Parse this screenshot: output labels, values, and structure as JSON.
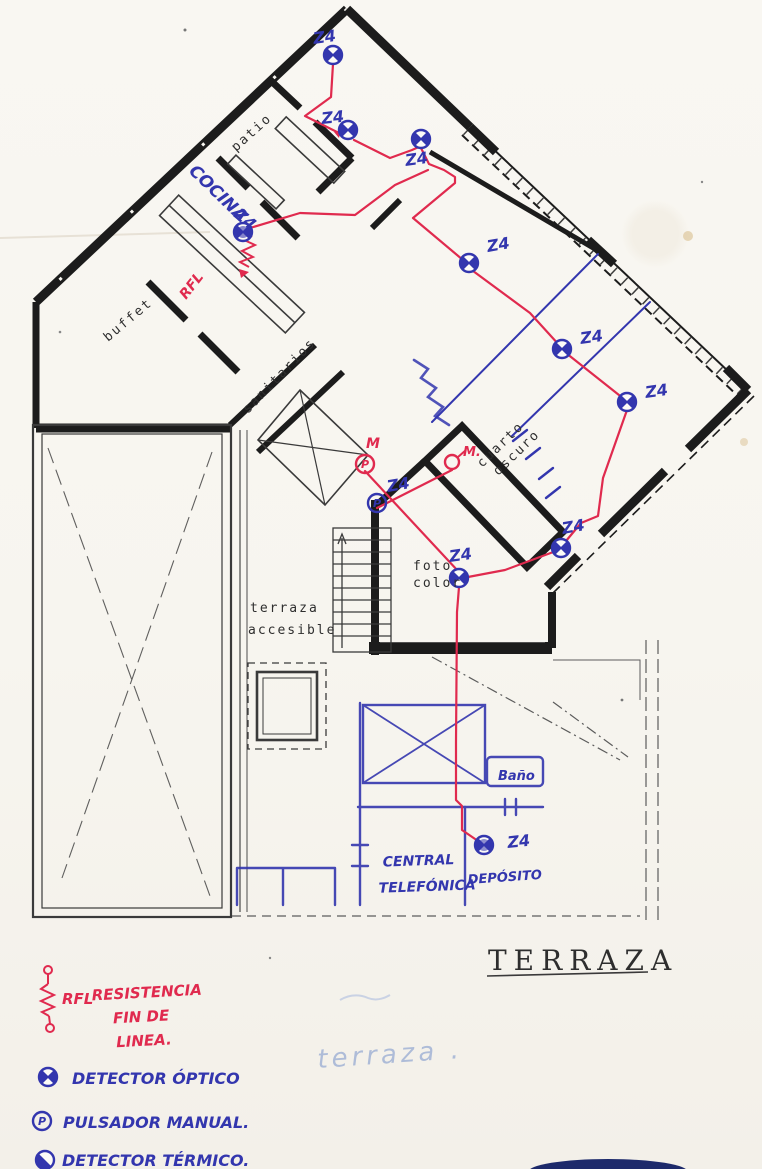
{
  "document": {
    "type": "scanned architectural floor plan with hand-drawn fire-alarm circuit",
    "sheet_title": "TERRAZA",
    "sheet_title_faded": "terraza ."
  },
  "colors": {
    "paper": "#f8f6f1",
    "wall_ink": "#1c1c1c",
    "circuit_red": "#e02a4e",
    "ink_blue": "#3336ae",
    "faded_blue": "#aebcd8",
    "pencil": "#2e2e2e"
  },
  "rooms": {
    "patio": "patio",
    "cocina": "COCINA",
    "buffet": "buffet",
    "sanitarios": "sanitarios",
    "cuarto_oscuro_1": "cuarto",
    "cuarto_oscuro_2": "oscuro",
    "foto_color_1": "foto",
    "foto_color_2": "color",
    "terraza_accesible_1": "terraza",
    "terraza_accesible_2": "accesible",
    "bano": "Baño",
    "central_telefonica_1": "CENTRAL",
    "central_telefonica_2": "TELEFÓNICA",
    "deposito": "DEPÓSITO"
  },
  "devices": {
    "points": [
      {
        "id": "detector-top-room",
        "type": "optical-detector",
        "zone": "Z4"
      },
      {
        "id": "detector-patio-hall",
        "type": "optical-detector",
        "zone": "Z4"
      },
      {
        "id": "detector-upper-hall",
        "type": "optical-detector",
        "zone": "Z4"
      },
      {
        "id": "detector-cocina",
        "type": "optical-detector",
        "zone": "Z4"
      },
      {
        "id": "detector-living-1",
        "type": "optical-detector",
        "zone": "Z4"
      },
      {
        "id": "detector-living-2",
        "type": "optical-detector",
        "zone": "Z4"
      },
      {
        "id": "detector-living-3",
        "type": "optical-detector",
        "zone": "Z4"
      },
      {
        "id": "detector-east-room",
        "type": "optical-detector",
        "zone": "Z4"
      },
      {
        "id": "detector-foto-color",
        "type": "optical-detector",
        "zone": "Z4"
      },
      {
        "id": "detector-deposito",
        "type": "optical-detector",
        "zone": "Z4"
      },
      {
        "id": "pulsador-stair-corner",
        "type": "manual-pushbutton",
        "zone": "Z4",
        "letter": "P"
      },
      {
        "id": "pulsador-manual-red",
        "type": "manual-pushbutton",
        "label": "M",
        "letter": "P"
      },
      {
        "id": "punto-manual-red-2",
        "type": "manual-point",
        "label": "M."
      },
      {
        "id": "rfl-cocina",
        "type": "end-of-line-resistor",
        "label": "RFL"
      }
    ]
  },
  "legend": {
    "rfl_abbr": "RFL",
    "rfl_line1": "RESISTENCIA",
    "rfl_line2": "FIN DE",
    "rfl_line3": "LINEA.",
    "optical_label": "DETECTOR ÓPTICO",
    "pulsador_label": "PULSADOR MANUAL.",
    "pulsador_letter": "P",
    "termico_label": "DETECTOR TÉRMICO."
  }
}
